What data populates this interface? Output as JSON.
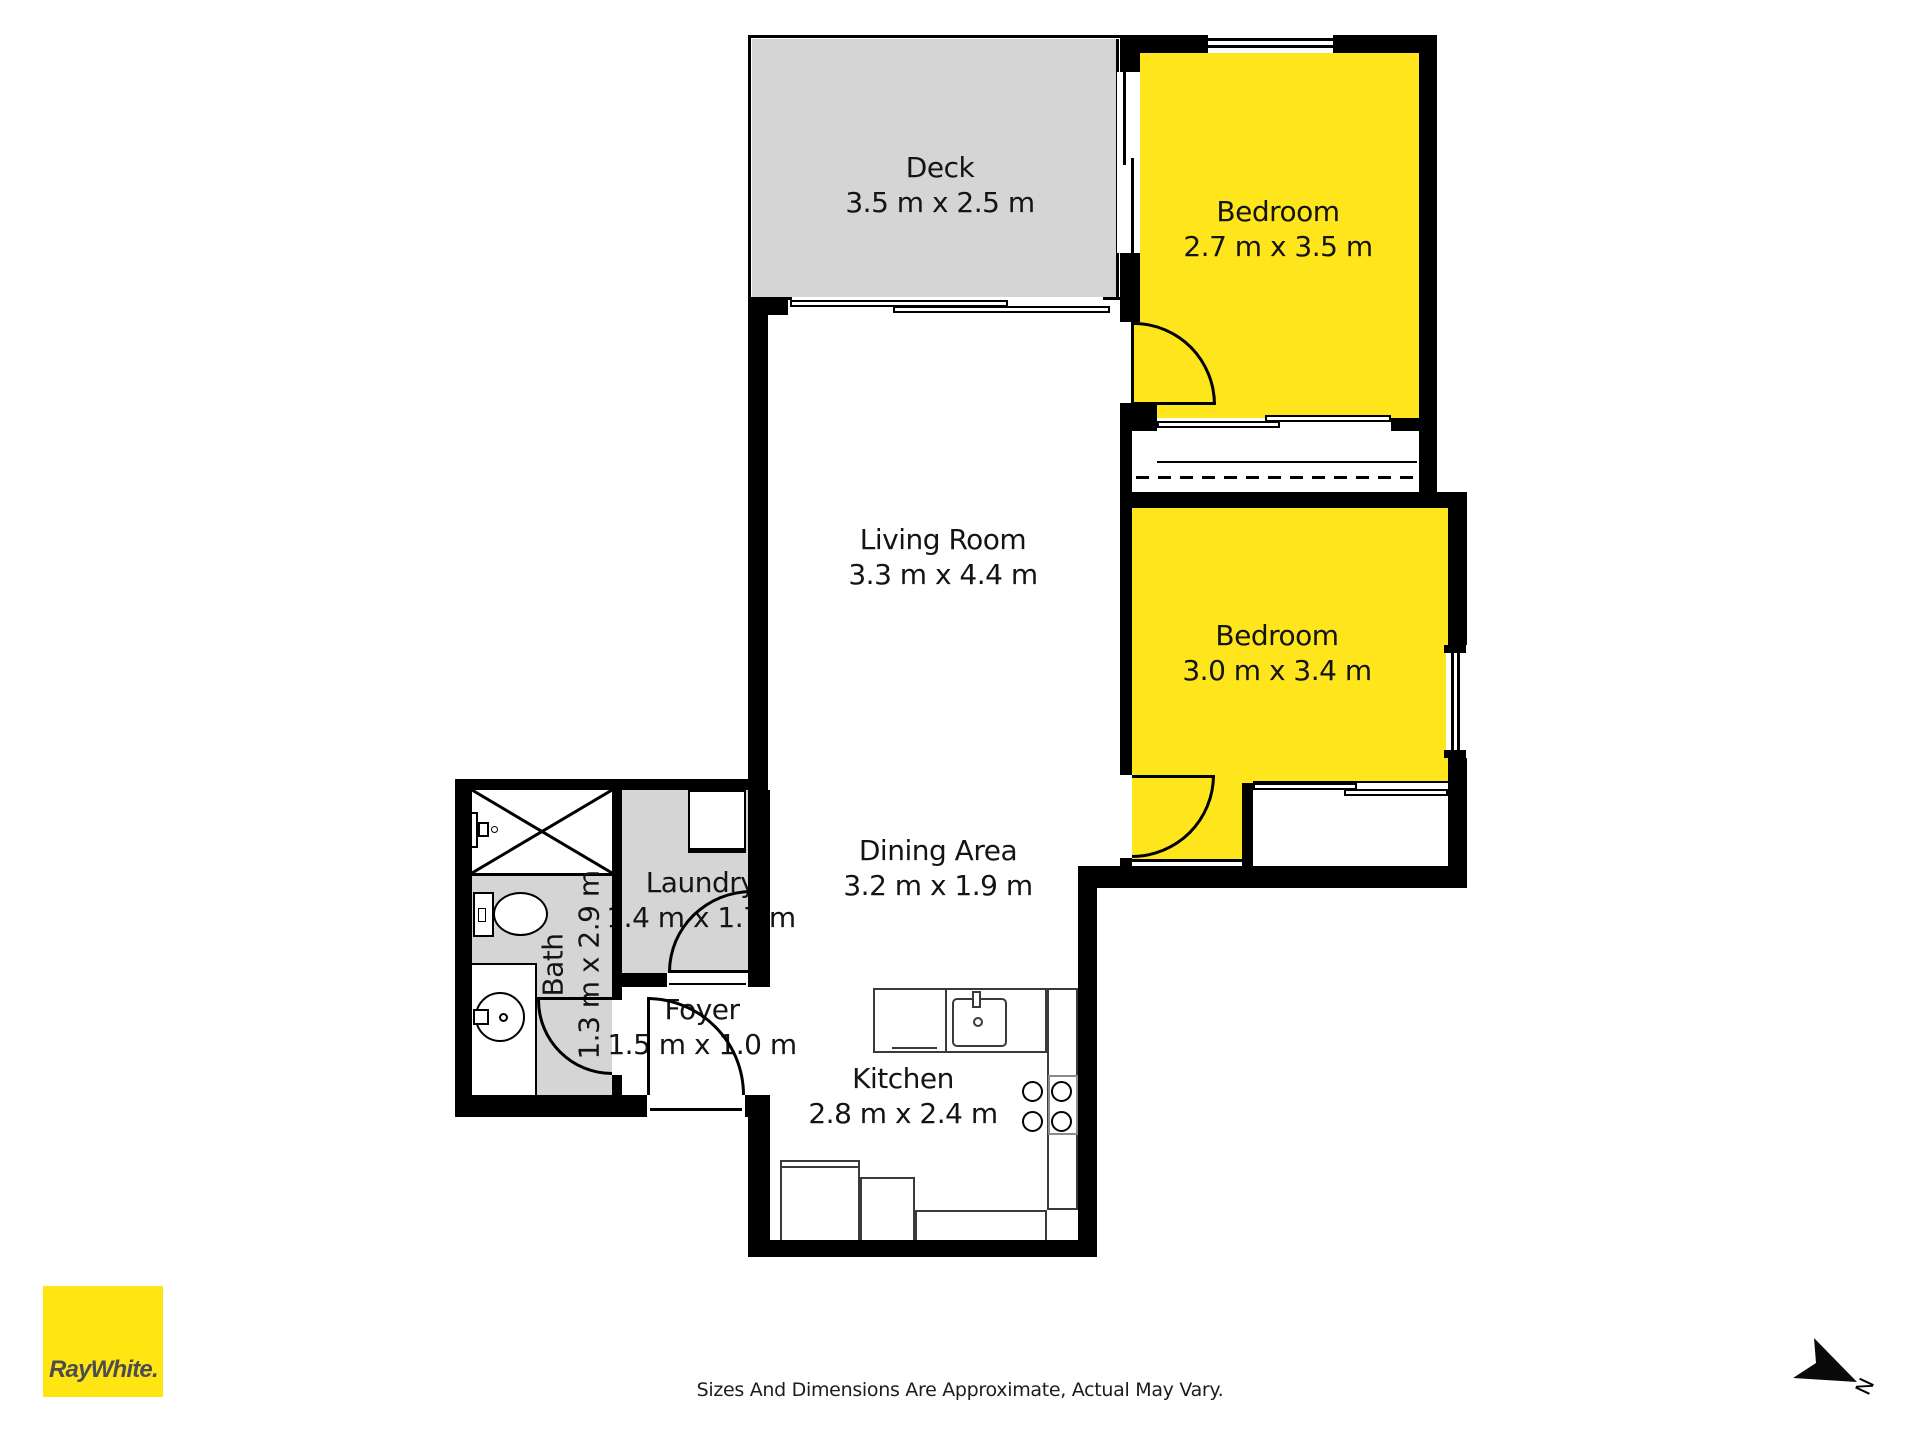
{
  "title": "Floor Plan",
  "rooms": [
    {
      "id": "deck",
      "name": "Deck",
      "dims": "3.5 m x 2.5 m"
    },
    {
      "id": "bedroom-1",
      "name": "Bedroom",
      "dims": "2.7 m x 3.5 m"
    },
    {
      "id": "living-room",
      "name": "Living Room",
      "dims": "3.3 m x 4.4 m"
    },
    {
      "id": "bedroom-2",
      "name": "Bedroom",
      "dims": "3.0 m x 3.4 m"
    },
    {
      "id": "dining-area",
      "name": "Dining Area",
      "dims": "3.2 m x 1.9 m"
    },
    {
      "id": "laundry",
      "name": "Laundry",
      "dims": "1.4 m x 1.7 m"
    },
    {
      "id": "foyer",
      "name": "Foyer",
      "dims": "1.5 m x 1.0 m"
    },
    {
      "id": "kitchen",
      "name": "Kitchen",
      "dims": "2.8 m x 2.4 m"
    },
    {
      "id": "bath",
      "name": "Bath",
      "dims": "1.3 m x 2.9 m"
    }
  ],
  "branding": {
    "logo_text": "RayWhite."
  },
  "compass": {
    "label": "N"
  },
  "disclaimer": "Sizes And Dimensions Are Approximate, Actual May Vary.",
  "colors": {
    "room_yellow": "#ffe61c",
    "floor_gray": "#d5d5d5",
    "wall_black": "#000000",
    "logo_yellow": "#ffe512",
    "logo_text": "#4d4d50"
  }
}
